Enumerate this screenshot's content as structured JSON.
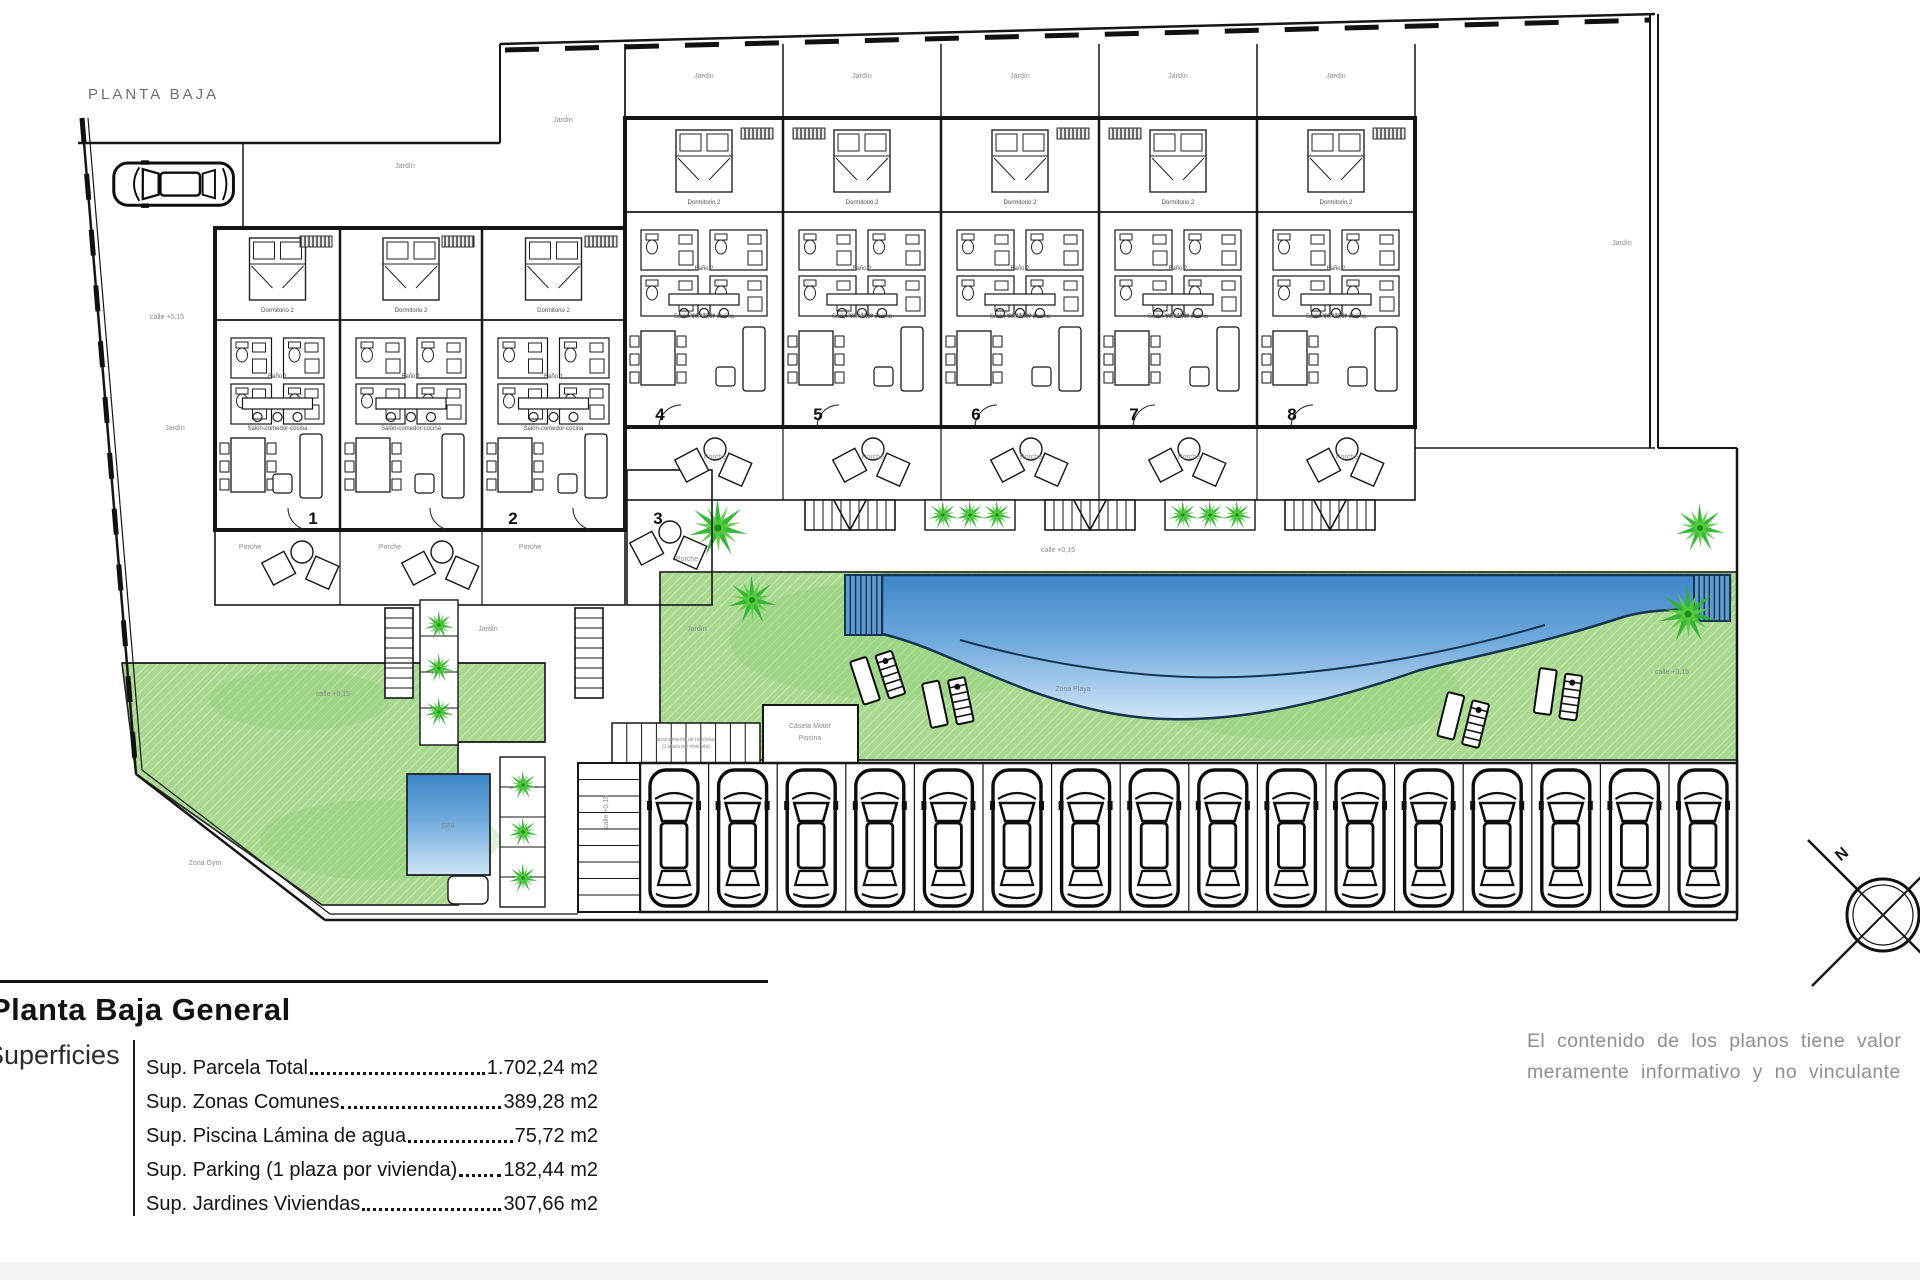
{
  "plan": {
    "title": "PLANTA BAJA",
    "compass": "N",
    "unit_numbers": [
      {
        "n": "1",
        "x": 313,
        "y": 524
      },
      {
        "n": "2",
        "x": 513,
        "y": 524
      },
      {
        "n": "3",
        "x": 658,
        "y": 524
      },
      {
        "n": "4",
        "x": 660,
        "y": 420
      },
      {
        "n": "5",
        "x": 818,
        "y": 420
      },
      {
        "n": "6",
        "x": 976,
        "y": 420
      },
      {
        "n": "7",
        "x": 1134,
        "y": 420
      },
      {
        "n": "8",
        "x": 1292,
        "y": 420
      }
    ],
    "rooms": {
      "d1": "Dormitorio 1",
      "d2": "Dormitorio 2",
      "b1": "Baño 1",
      "b2": "Baño 2",
      "living": "Salón-comedor-cocina"
    },
    "labels": [
      {
        "t": "Jardín",
        "x": 563,
        "y": 122
      },
      {
        "t": "Jardín",
        "x": 405,
        "y": 168
      },
      {
        "t": "Jardín",
        "x": 175,
        "y": 430
      },
      {
        "t": "Jardín",
        "x": 704,
        "y": 78
      },
      {
        "t": "Jardín",
        "x": 862,
        "y": 78
      },
      {
        "t": "Jardín",
        "x": 1020,
        "y": 78
      },
      {
        "t": "Jardín",
        "x": 1178,
        "y": 78
      },
      {
        "t": "Jardín",
        "x": 1336,
        "y": 78
      },
      {
        "t": "Jardín",
        "x": 1622,
        "y": 245
      },
      {
        "t": "Jardín",
        "x": 488,
        "y": 631
      },
      {
        "t": "Jardín",
        "x": 697,
        "y": 631
      },
      {
        "t": "Porche",
        "x": 250,
        "y": 549
      },
      {
        "t": "Porche",
        "x": 390,
        "y": 549
      },
      {
        "t": "Porche",
        "x": 530,
        "y": 549
      },
      {
        "t": "Porche",
        "x": 687,
        "y": 561
      },
      {
        "t": "Porche",
        "x": 715,
        "y": 459
      },
      {
        "t": "Porche",
        "x": 873,
        "y": 459
      },
      {
        "t": "Porche",
        "x": 1031,
        "y": 459
      },
      {
        "t": "Porche",
        "x": 1189,
        "y": 459
      },
      {
        "t": "Porche",
        "x": 1347,
        "y": 459
      },
      {
        "t": "calle +0,15",
        "x": 167,
        "y": 319
      },
      {
        "t": "calle +0,15",
        "x": 333,
        "y": 696
      },
      {
        "t": "calle +0,15",
        "x": 1058,
        "y": 552
      },
      {
        "t": "calle +0,15",
        "x": 1672,
        "y": 674
      },
      {
        "t": "calle +0,15",
        "x": 608,
        "y": 812,
        "r": -90
      },
      {
        "t": "Zona Playa",
        "x": 1073,
        "y": 691
      },
      {
        "t": "SPA",
        "x": 448,
        "y": 828
      },
      {
        "t": "Zona Gym",
        "x": 205,
        "y": 865
      },
      {
        "t": "Caseta Motor",
        "x": 810,
        "y": 728
      },
      {
        "t": "Piscina",
        "x": 810,
        "y": 740
      },
      {
        "t": "aparcamiento de bicicletas",
        "x": 686,
        "y": 741,
        "s": 5
      },
      {
        "t": "(1 plaza por vivienda)",
        "x": 686,
        "y": 748,
        "s": 5
      }
    ],
    "colors": {
      "green": "#a8d98f",
      "green_dark": "#7cc968",
      "palm": "#2fb32f",
      "palm_light": "#55cb3e",
      "pool_deep": "#3d86c8",
      "pool_mid": "#6ea9dc",
      "pool_shallow": "#cfe6f7",
      "wall": "#161616",
      "label_gray": "#8a8a8a",
      "room_gray": "#4a4a4a"
    }
  },
  "legend": {
    "title": "Planta Baja General",
    "section": "Superficies",
    "rows": [
      {
        "label": "Sup. Parcela Total ",
        "value": "1.702,24 m2"
      },
      {
        "label": "Sup. Zonas Comunes ",
        "value": "389,28 m2"
      },
      {
        "label": "Sup. Piscina Lámina de agua",
        "value": "75,72 m2"
      },
      {
        "label": "Sup. Parking (1 plaza por vivienda)",
        "value": "182,44 m2"
      },
      {
        "label": "Sup. Jardines Viviendas",
        "value": "307,66 m2"
      }
    ]
  },
  "disclaimer": {
    "line1": "El contenido de los planos tiene valor",
    "line2": "meramente informativo y no vinculante"
  }
}
